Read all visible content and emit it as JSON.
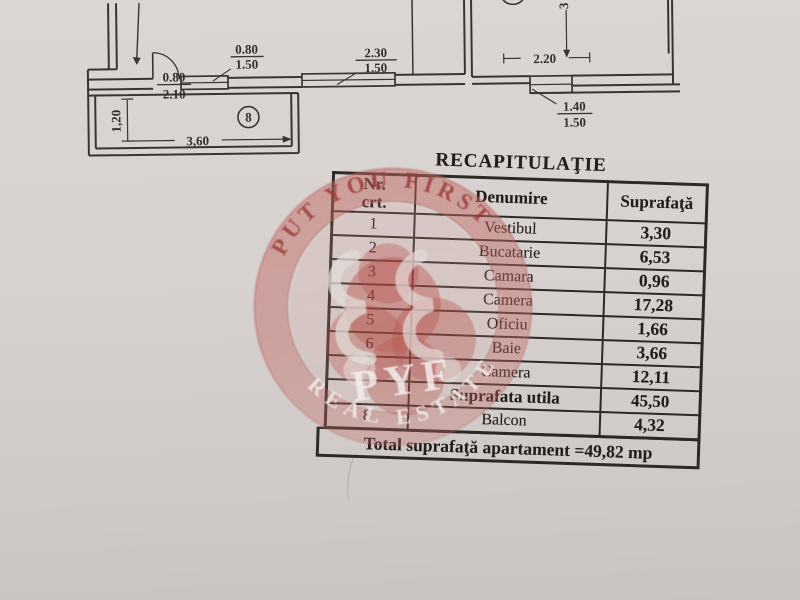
{
  "floor_plan": {
    "room_number": "8",
    "labels": {
      "door_w": "0.80",
      "door_h": "2.10",
      "win1_w": "0.80",
      "win1_h": "1.50",
      "win2_w": "2.30",
      "win2_h": "1.50",
      "dim_220": "2.20",
      "dim_3": "3",
      "win3_w": "1.40",
      "win3_h": "1.50",
      "balcony_depth": "1,20",
      "balcony_width": "3,60"
    }
  },
  "table": {
    "title": "RECAPITULAŢIE",
    "header": {
      "nr_line1": "Nr.",
      "nr_line2": "crt.",
      "denumire": "Denumire",
      "suprafata": "Suprafaţă"
    },
    "rows": [
      {
        "nr": "1",
        "name": "Vestibul",
        "area": "3,30"
      },
      {
        "nr": "2",
        "name": "Bucatarie",
        "area": "6,53"
      },
      {
        "nr": "3",
        "name": "Camara",
        "area": "0,96"
      },
      {
        "nr": "4",
        "name": "Camera",
        "area": "17,28"
      },
      {
        "nr": "5",
        "name": "Oficiu",
        "area": "1,66"
      },
      {
        "nr": "6",
        "name": "Baie",
        "area": "3,66"
      },
      {
        "nr": "7",
        "name": "Camera",
        "area": "12,11"
      },
      {
        "nr": "",
        "name": "Suprafata utila",
        "area": "45,50"
      },
      {
        "nr": "8",
        "name": "Balcon",
        "area": "4,32"
      }
    ],
    "total": "Total suprafaţă apartament =49,82 mp"
  },
  "watermark": {
    "arc_top": "PUT YOU FIRST",
    "arc_bottom": "REAL ESTATE",
    "monogram": "PYF",
    "ring_color": "#c06a64",
    "arc_top_color": "#9e3e3a",
    "paper_color": "#d7d2d0"
  }
}
